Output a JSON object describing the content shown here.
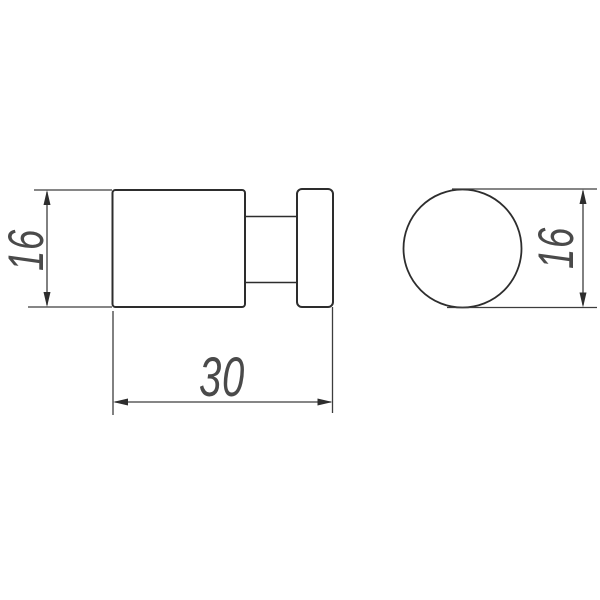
{
  "drawing": {
    "background_color": "#ffffff",
    "object_line_color": "#2d2d2d",
    "dimension_line_color": "#3d3d3d",
    "dimension_text_color": "#4a4a4a",
    "side_view": {
      "height_dimension": {
        "label": "16"
      },
      "length_dimension": {
        "label": "30"
      }
    },
    "front_view": {
      "diameter_dimension": {
        "label": "16"
      }
    }
  }
}
